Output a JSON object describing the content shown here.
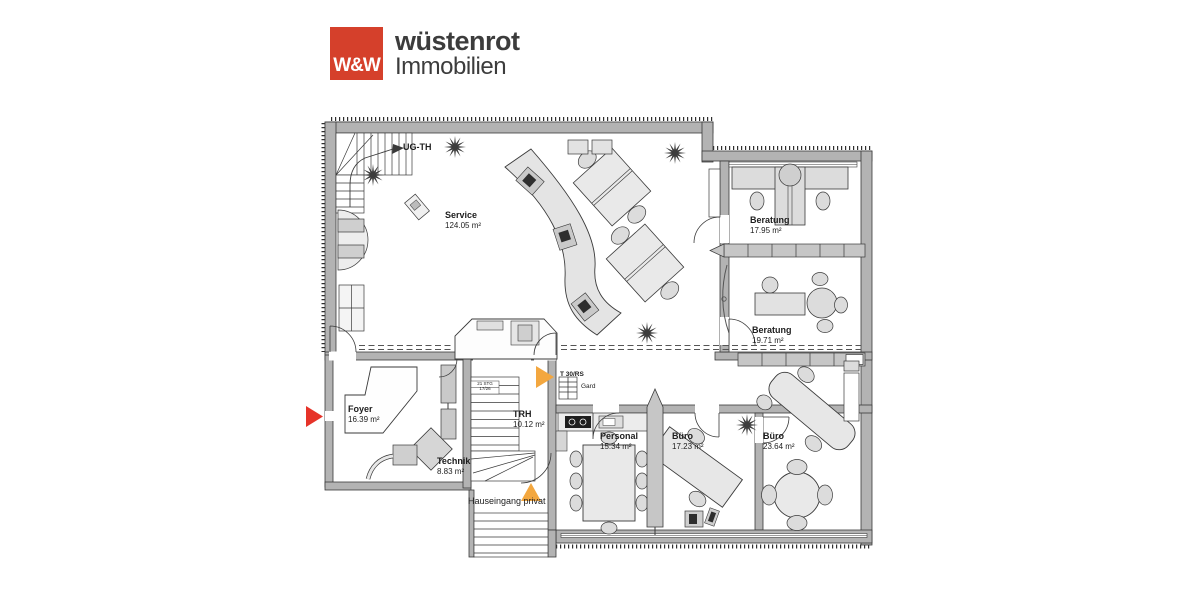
{
  "logo": {
    "mark": "W&W",
    "name": "wüstenrot",
    "subtitle": "Immobilien",
    "brand_color": "#d5402b"
  },
  "rooms": {
    "service": {
      "name": "Service",
      "area": "124.05 m²"
    },
    "beratung_top": {
      "name": "Beratung",
      "area": "17.95 m²"
    },
    "beratung_mid": {
      "name": "Beratung",
      "area": "19.71 m²"
    },
    "foyer": {
      "name": "Foyer",
      "area": "16.39 m²"
    },
    "trh": {
      "name": "TRH",
      "area": "10.12 m²"
    },
    "technik": {
      "name": "Technik",
      "area": "8.83 m²"
    },
    "personal": {
      "name": "Personal",
      "area": "15.34 m²"
    },
    "buero_mid": {
      "name": "Büro",
      "area": "17.23 m²"
    },
    "buero_right": {
      "name": "Büro",
      "area": "23.64 m²"
    }
  },
  "annotations": {
    "stair_label": "UG-TH",
    "stair_spec_line1": "21 STG",
    "stair_spec_line2": "17/26",
    "fire_door": "T 30/RS",
    "wardrobe": "Gard",
    "private_entrance": "Hauseingang privat"
  },
  "markers": {
    "entrance_color": "#e63329",
    "fire_door_color": "#f3a73f"
  }
}
